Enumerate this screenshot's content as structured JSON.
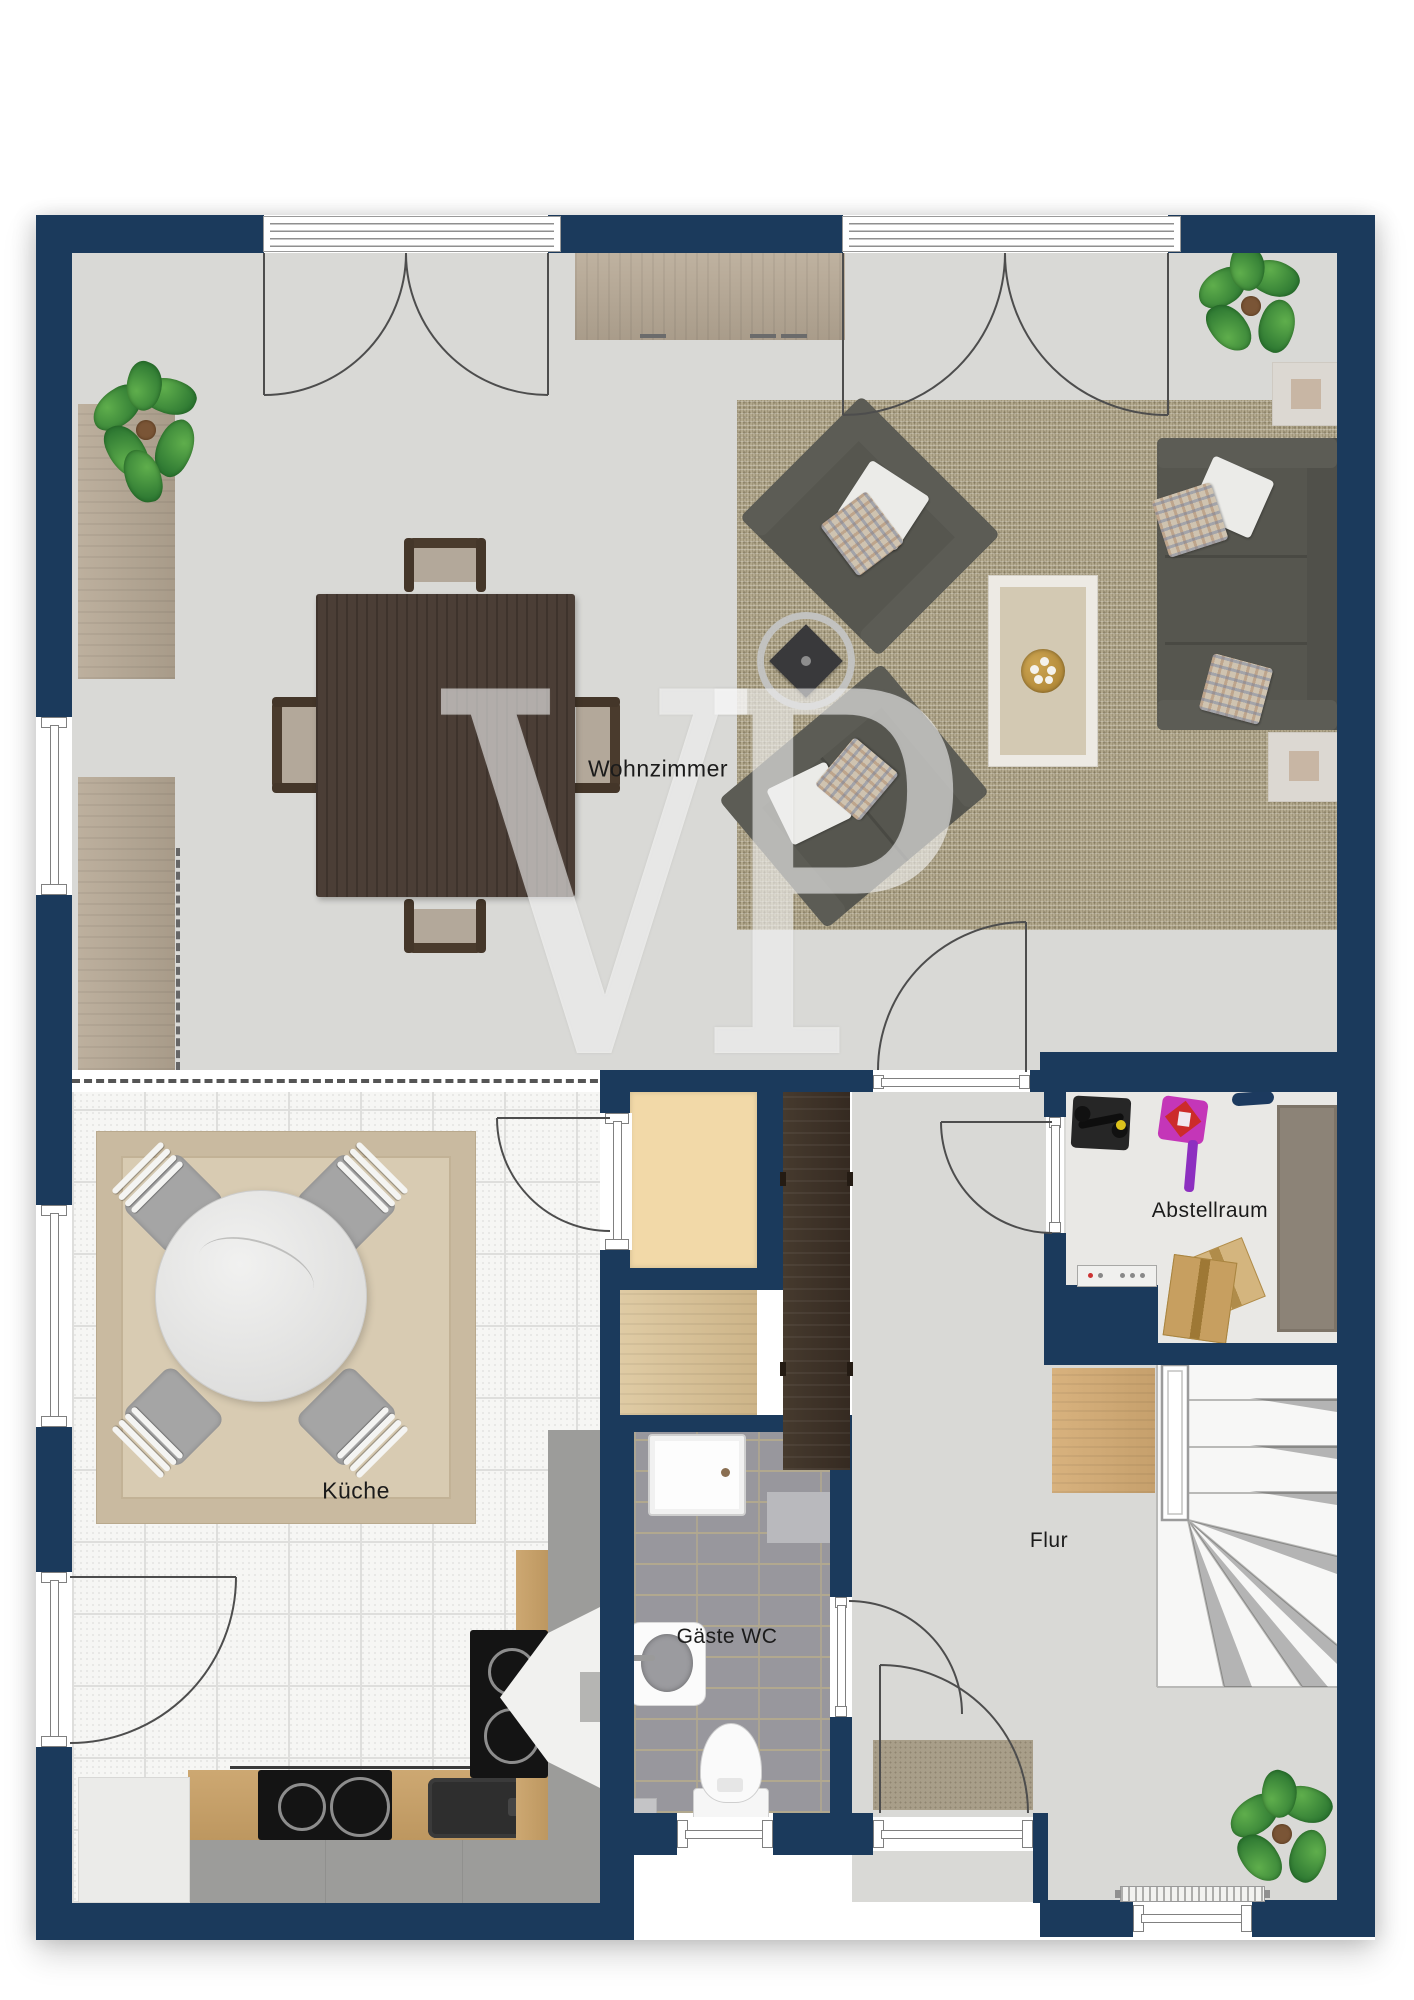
{
  "watermark_text": "VP",
  "rooms": {
    "wohnzimmer": {
      "label": "Wohnzimmer"
    },
    "kueche": {
      "label": "Küche"
    },
    "gaeste_wc": {
      "label": "Gäste WC"
    },
    "flur": {
      "label": "Flur"
    },
    "abstellraum": {
      "label": "Abstellraum"
    }
  },
  "colors": {
    "wall": "#1b3a5c",
    "living_floor": "#d9d9d6",
    "kitchen_floor": "#f6f6f4",
    "wc_floor": "#98979d",
    "storage_floor": "#e9e8e5",
    "shaft": "#f2d9a8",
    "rug_living": "#b2a88d",
    "rug_kitchen": "#d8cbb2",
    "sofa": "#56564f",
    "wood_light": "#b4a795",
    "wood_dark": "#4b3e36",
    "wardrobe_dark": "#3b2f26",
    "wardrobe_light": "#d2ab77",
    "watermark": "rgba(255,255,255,0.55)"
  }
}
